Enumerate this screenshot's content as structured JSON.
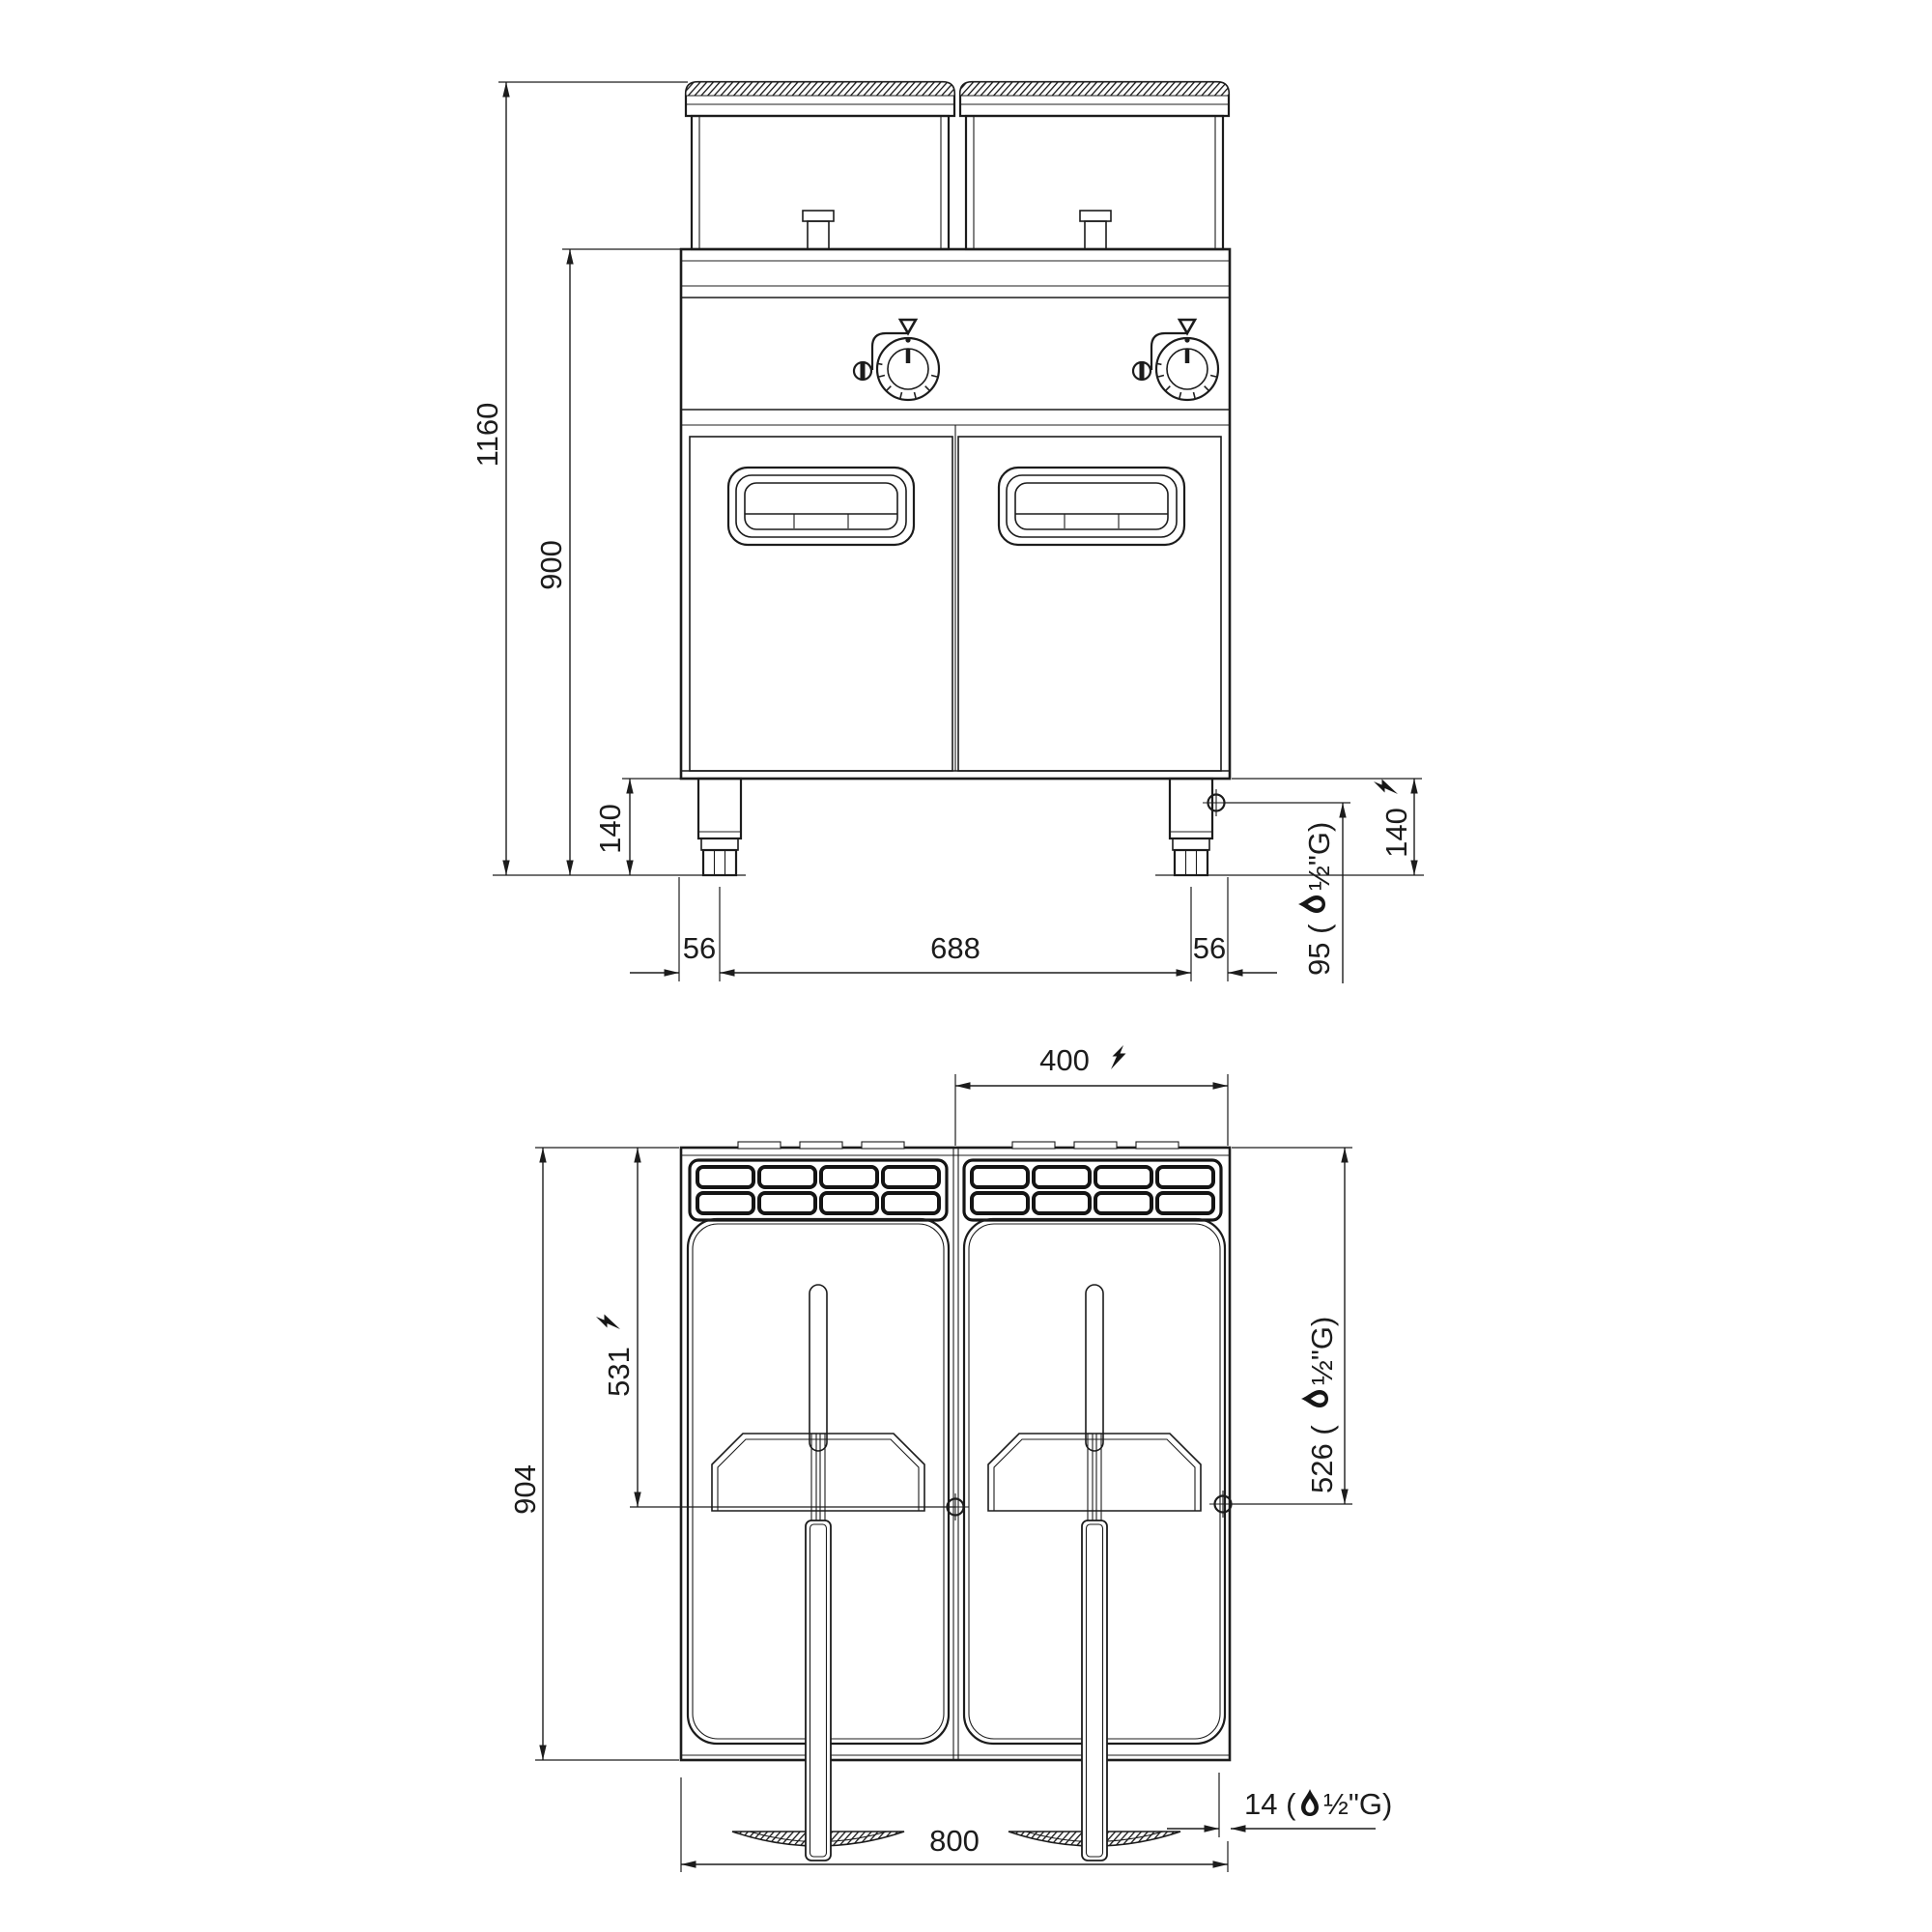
{
  "drawing": {
    "title": "gas-double-fryer-dimension-drawing",
    "front_view": {
      "dim_total_height": "1160",
      "dim_body_height": "900",
      "dim_leg_height_left": "140",
      "dim_leg_height_right": "140",
      "dim_edge_to_leg_left": "56",
      "dim_leg_spacing": "688",
      "dim_edge_to_leg_right": "56",
      "dim_gas_height_prefix": "95 (",
      "dim_gas_height_suffix": "½\"G)"
    },
    "top_view": {
      "dim_center_to_edge": "400",
      "dim_depth": "904",
      "dim_elec_connection_depth": "531",
      "dim_gas_connection_depth_prefix": "526 (",
      "dim_gas_connection_depth_suffix": "½\"G)",
      "dim_width": "800",
      "dim_gas_edge_offset_prefix": "14 (",
      "dim_gas_edge_offset_suffix": "½\"G)"
    },
    "icons": {
      "lightning": "electric-connection-icon",
      "flame": "gas-connection-icon",
      "crosshair": "connection-point-icon"
    },
    "colors": {
      "ink": "#1c1c1c",
      "background": "#ffffff"
    }
  }
}
